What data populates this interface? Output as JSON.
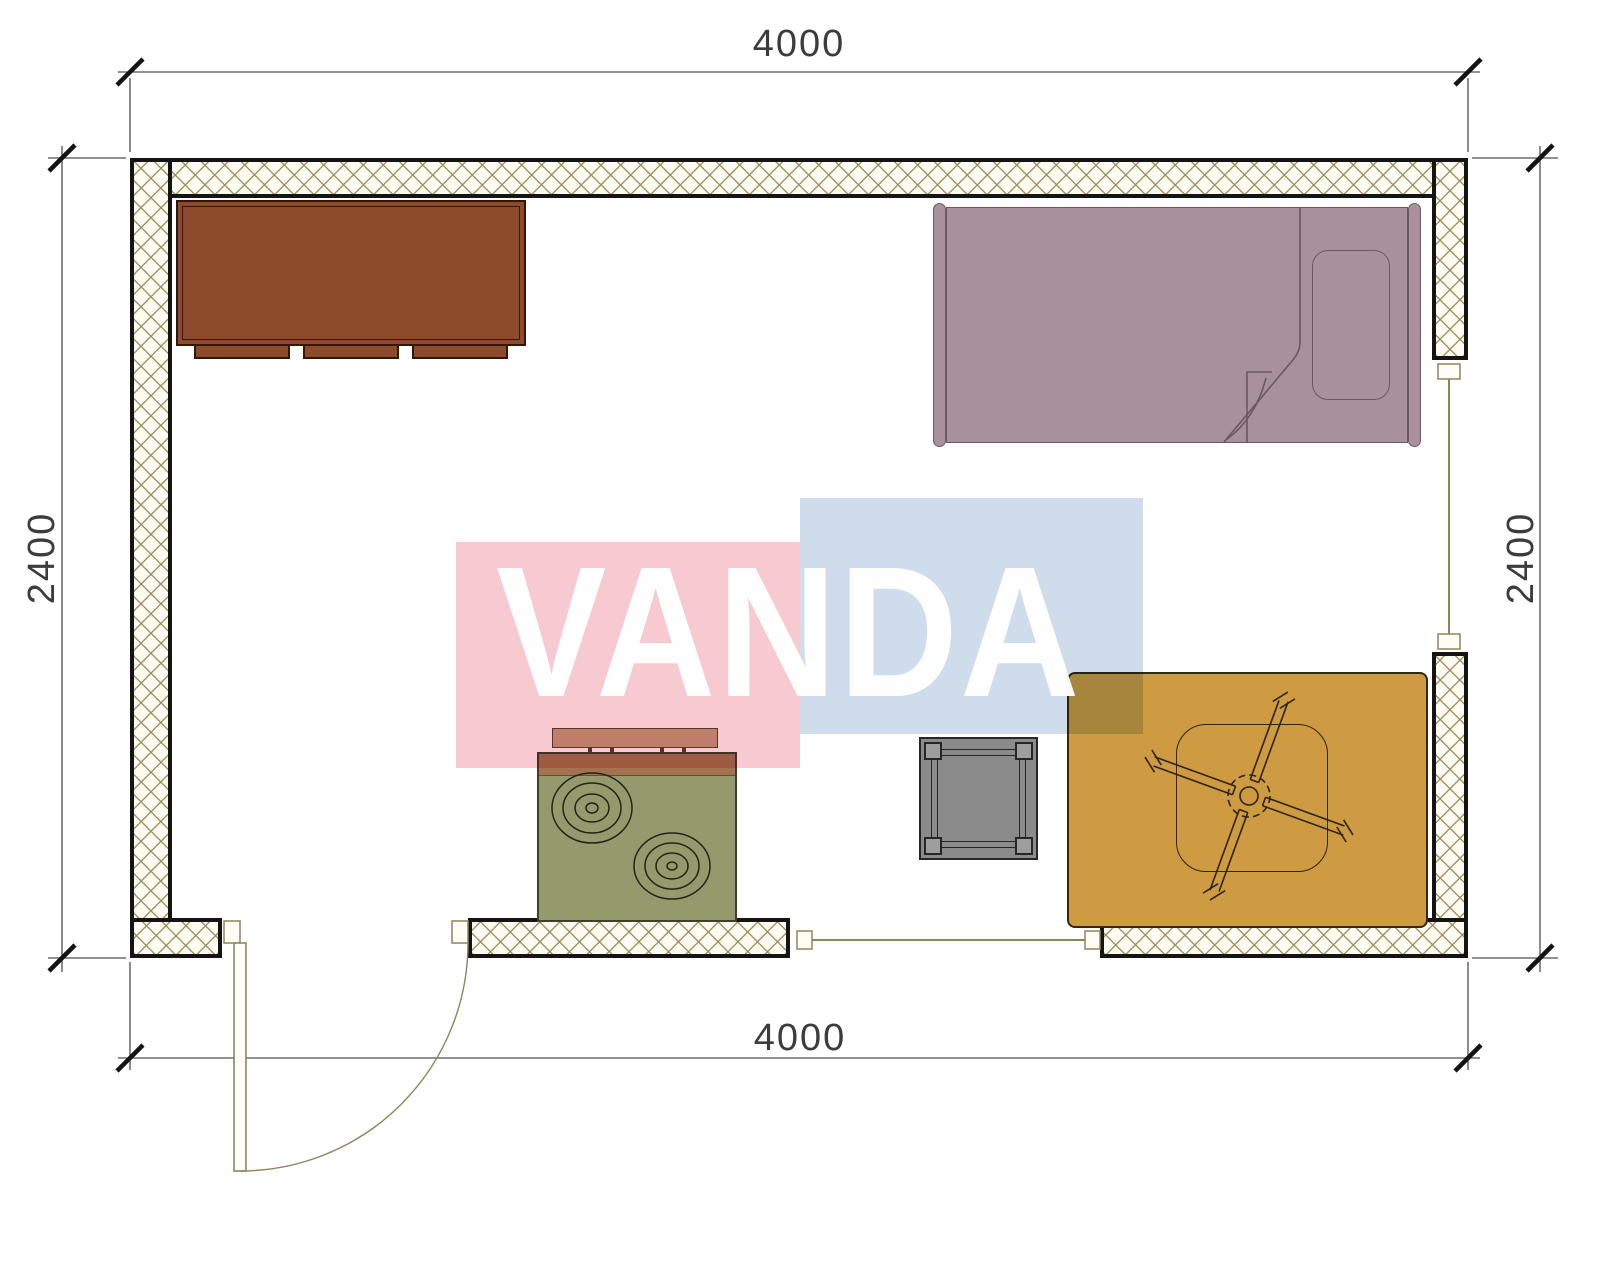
{
  "document": {
    "kind": "architectural-floor-plan"
  },
  "dimensions": {
    "top": "4000",
    "bottom": "4000",
    "left": "2400",
    "right": "2400"
  },
  "watermark": {
    "text": "VANDA",
    "pink_block_color": "#f7cad2",
    "blue_block_color": "#cedceb",
    "text_color": "#ffffff"
  },
  "palette": {
    "wall_hatch": "#9b8a58",
    "wall_border": "#141414",
    "wardrobe": "#8d4b2b",
    "bed": "#a9919b",
    "stove_body": "#959a6d",
    "stove_top_band": "#a3734f",
    "shelf": "#c49f80",
    "side_table": "#8b8b8b",
    "rug": "#ce9a42",
    "door_window_line": "#93835a",
    "dimension_text": "#3c3c3c"
  },
  "furniture": [
    {
      "name": "wardrobe"
    },
    {
      "name": "single-bed"
    },
    {
      "name": "pillow"
    },
    {
      "name": "stove"
    },
    {
      "name": "wall-shelf"
    },
    {
      "name": "side-table"
    },
    {
      "name": "rug"
    },
    {
      "name": "ceiling-fan"
    }
  ],
  "openings": [
    {
      "name": "door"
    },
    {
      "name": "window-bottom"
    },
    {
      "name": "window-right"
    }
  ]
}
